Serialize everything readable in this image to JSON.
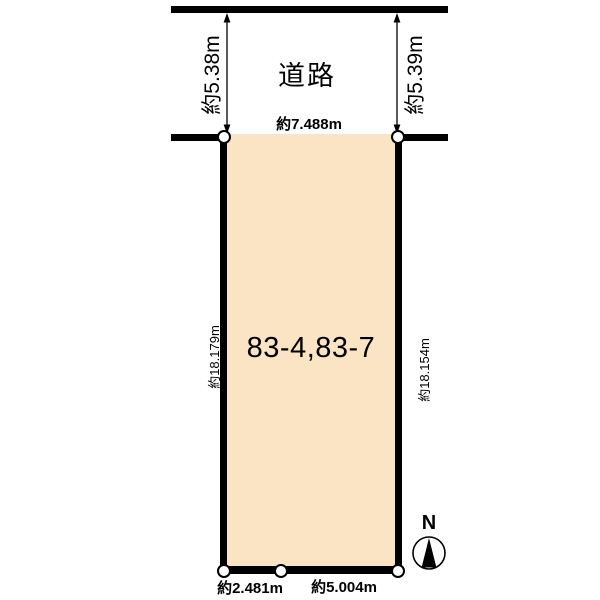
{
  "road": {
    "label": "道路",
    "frontage_left": "約5.38m",
    "frontage_right": "約5.39m"
  },
  "parcel": {
    "label": "83-4,83-7",
    "top_edge": "約7.488m",
    "left_edge": "約18.179m",
    "right_edge": "約18.154m",
    "bottom_left_edge": "約2.481m",
    "bottom_right_edge": "約5.004m"
  },
  "compass": {
    "label": "N"
  },
  "colors": {
    "parcel_fill": "#FAE4C4",
    "line": "#000000",
    "background": "#FFFFFF"
  }
}
